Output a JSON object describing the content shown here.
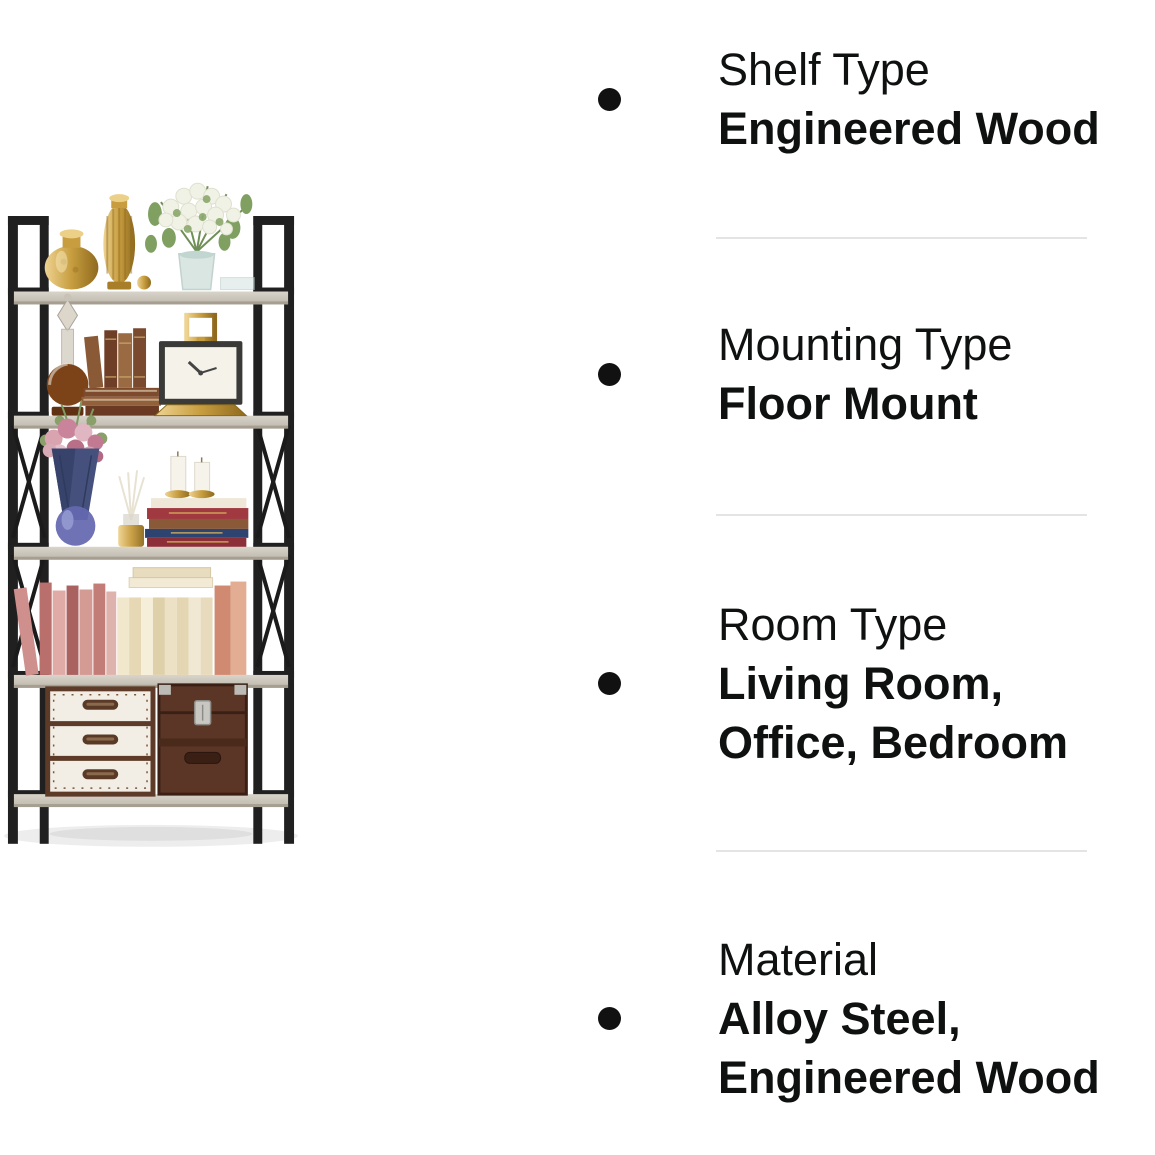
{
  "page": {
    "background_color": "#ffffff",
    "text_color": "#0f1111",
    "divider_color": "#e4e4e4",
    "bullet_color": "#111111"
  },
  "icons": {
    "bullet": "filled-circle"
  },
  "product_image": {
    "description": "Five-tier bookshelf with black metal frame and light grey wood shelves, styled with gold vases, a white flower bouquet, vintage books, a gold clock, a pink bouquet, candles, rows of pink and cream books, and two vintage storage trunks"
  },
  "features": [
    {
      "label": "Shelf Type",
      "value": "Engineered Wood"
    },
    {
      "label": "Mounting Type",
      "value": "Floor Mount"
    },
    {
      "label": "Room Type",
      "value": "Living Room, Office, Bedroom"
    },
    {
      "label": "Material",
      "value": "Alloy Steel, Engineered Wood"
    }
  ]
}
